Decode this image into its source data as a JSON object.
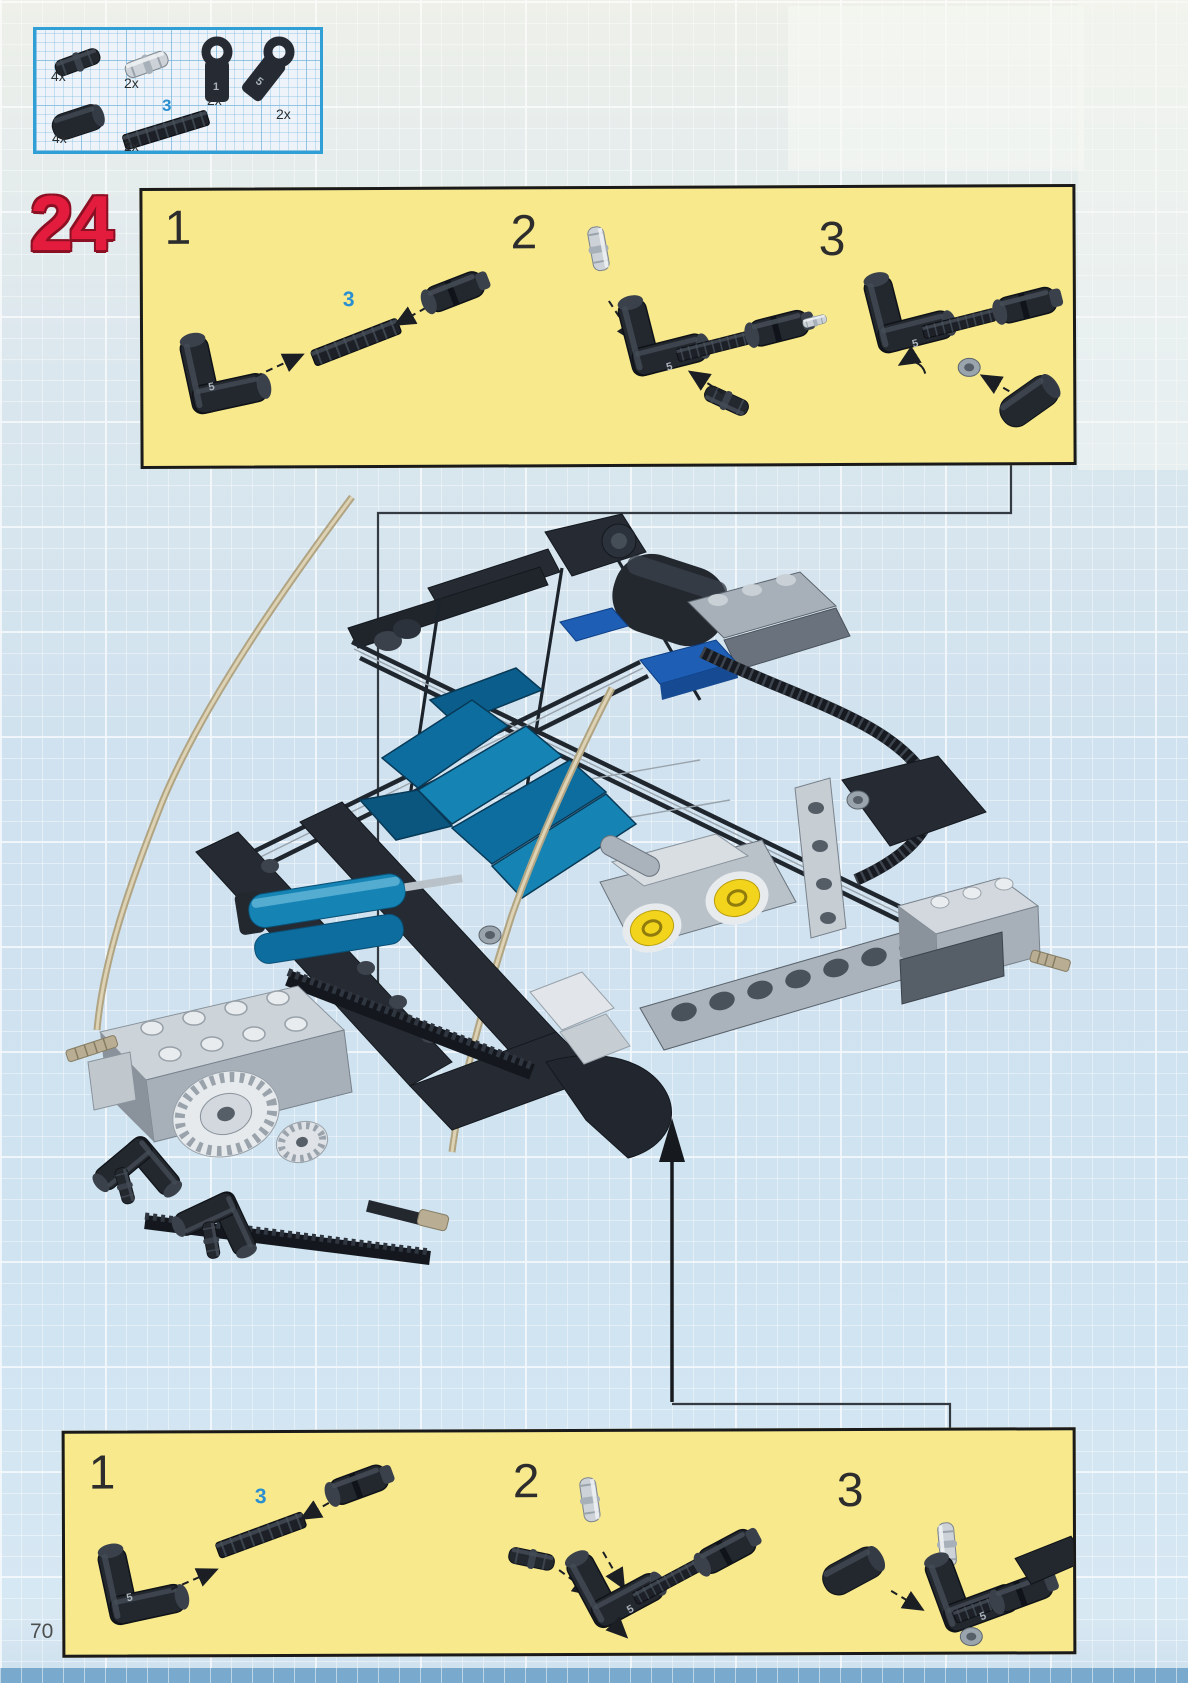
{
  "page": {
    "number": "70"
  },
  "step": {
    "number": "24"
  },
  "parts_box": {
    "items": [
      {
        "name": "black-connector-pin",
        "qty": "4x"
      },
      {
        "name": "light-gray-axle-pin",
        "qty": "2x"
      },
      {
        "name": "axle-connector-1",
        "qty": "2x",
        "molded": "1"
      },
      {
        "name": "angle-connector-5",
        "qty": "2x",
        "molded": "5"
      },
      {
        "name": "black-rubber-sleeve",
        "qty": "4x"
      },
      {
        "name": "black-axle-3",
        "qty": "2x",
        "length_label": "3"
      }
    ]
  },
  "panels": {
    "top": {
      "steps": [
        {
          "num": "1"
        },
        {
          "num": "2"
        },
        {
          "num": "3"
        }
      ],
      "axle_label": "3",
      "molded": "5"
    },
    "bottom": {
      "steps": [
        {
          "num": "1"
        },
        {
          "num": "2"
        },
        {
          "num": "3"
        }
      ],
      "axle_label": "3",
      "molded": "5"
    }
  },
  "colors": {
    "step_red": "#e31c3d",
    "panel_yellow": "#f7e98c",
    "callout_border_blue": "#2f9fd6",
    "axle_label_blue": "#2a8fd0",
    "engine_yellow": "#f2d41c",
    "pneumatic_blue": "#1584b4",
    "seat_teal": "#0e6d9f",
    "tube_tan": "#c9bd9b"
  }
}
